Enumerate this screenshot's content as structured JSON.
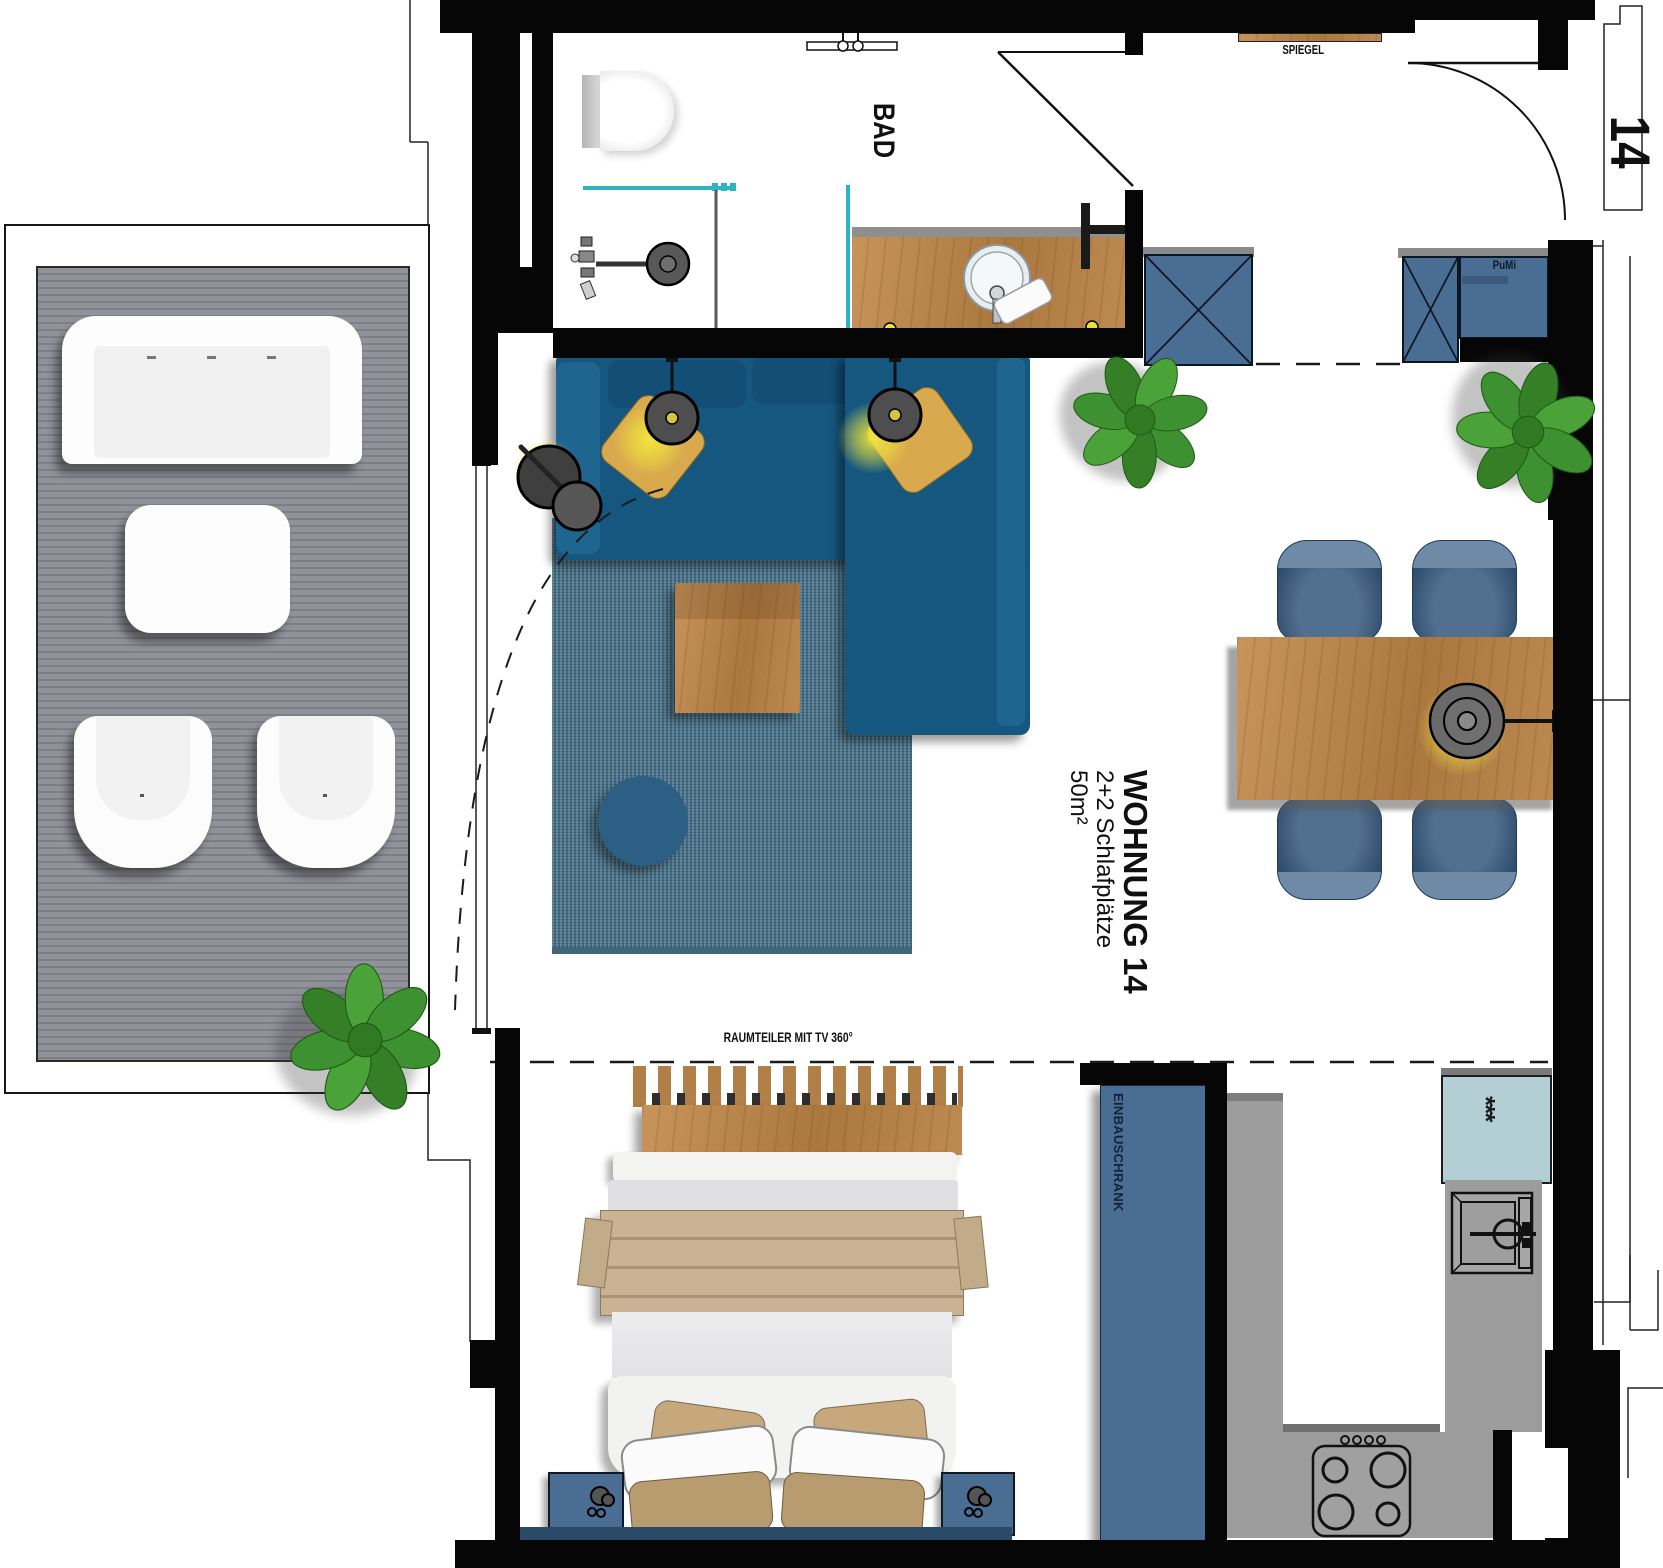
{
  "floorplan": {
    "unit": {
      "number": "14",
      "title": "WOHNUNG 14",
      "sleeping_places": "2+2 Schlafplätze",
      "area": "50m²"
    },
    "labels": {
      "bathroom": "BAD",
      "mirror": "SPIEGEL",
      "cleaning_cabinet": "PuMi",
      "room_divider": "RAUMTEILER MIT TV 360°",
      "built_in_wardrobe": "EINBAUSCHRANK",
      "freezer_symbol": "***"
    },
    "rooms": [
      {
        "name": "balcony",
        "items": [
          "outdoor-bench",
          "outdoor-table",
          "outdoor-chair",
          "outdoor-chair",
          "plant"
        ]
      },
      {
        "name": "bathroom",
        "items": [
          "toilet",
          "shower",
          "washbasin-vanity",
          "mirror",
          "towel-rail"
        ]
      },
      {
        "name": "living-dining",
        "items": [
          "corner-sofa",
          "rug",
          "coffee-table",
          "pouf",
          "pendant-light",
          "pendant-light",
          "floor-lamp",
          "dining-table",
          "dining-chair",
          "dining-chair",
          "dining-chair",
          "dining-chair",
          "wall-lamp",
          "wardrobe",
          "pumi-cabinet",
          "plant",
          "plant"
        ]
      },
      {
        "name": "sleeping-area",
        "items": [
          "double-bed",
          "nightstand",
          "nightstand",
          "room-divider-tv"
        ]
      },
      {
        "name": "kitchen",
        "items": [
          "built-in-wardrobe",
          "fridge-freezer",
          "sink",
          "stove",
          "counter"
        ]
      }
    ],
    "colors": {
      "wall": "#060606",
      "sofa_blue": "#16577f",
      "cabinet_blue": "#4a6d94",
      "rug_blue": "#4e7a92",
      "wood": "#bd8b55",
      "kitchen_gray": "#9c9c9c",
      "fridge_teal": "#b3ced4",
      "glass_teal": "#2fb4bf",
      "deck_gray": "#8b8b90",
      "plant_green": "#3f8f2f",
      "glow_yellow": "#f0e83a",
      "blanket_tan": "#c9b394",
      "navy_runner": "#2a4a68"
    }
  }
}
